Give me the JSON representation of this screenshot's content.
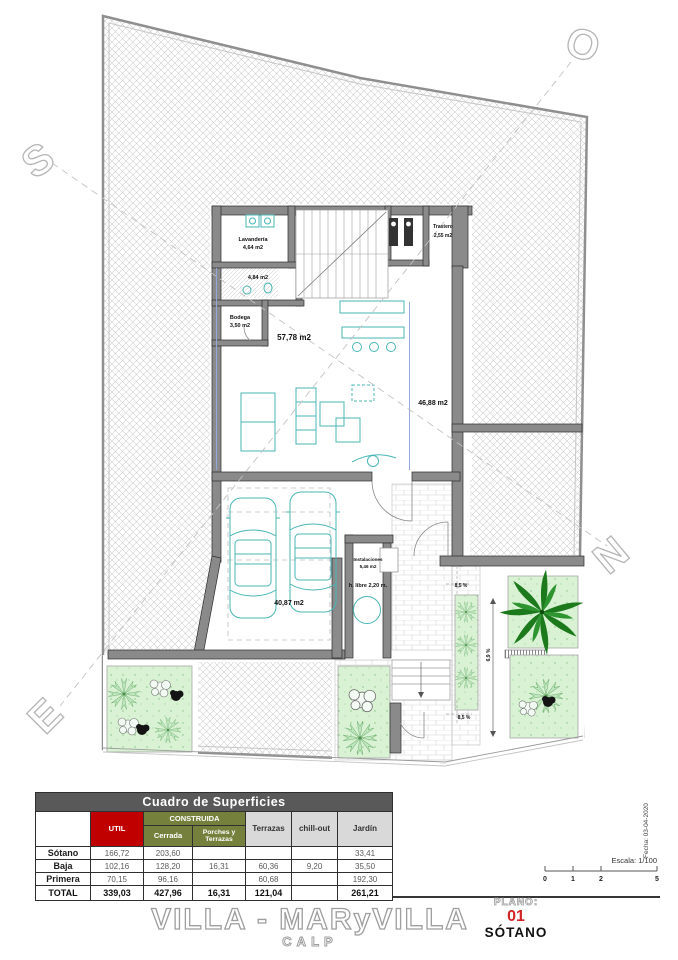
{
  "plan": {
    "compass": {
      "s": "S",
      "o": "O",
      "n": "N",
      "e": "E"
    },
    "rooms": {
      "lavanderia": {
        "name": "Lavandería",
        "area": "4,64 m2"
      },
      "bano": {
        "area": "4,84 m2"
      },
      "bodega": {
        "name": "Bodega",
        "area": "3,50 m2"
      },
      "trastero": {
        "name": "Trastero",
        "area": "2,55 m2"
      },
      "salon": {
        "area": "57,78 m2"
      },
      "terraza": {
        "area": "46,88 m2"
      },
      "garaje": {
        "area": "40,87 m2"
      },
      "instalaciones": {
        "name": "Instalaciones",
        "area": "5,46 m2"
      },
      "altura_libre": {
        "label": "h. libre 2,20 m."
      }
    },
    "ramps": {
      "top": "8,5 %",
      "middle": "6,9 %",
      "bottom": "8,5 %"
    }
  },
  "table": {
    "title": "Cuadro de Superficies",
    "construida_header": "CONSTRUIDA",
    "columns": {
      "util": "UTIL",
      "cerrada": "Cerrada",
      "porches": "Porches y Terrazas",
      "terrazas": "Terrazas",
      "chillout": "chill-out",
      "jardin": "Jardín"
    },
    "rows": [
      {
        "label": "Sótano",
        "cells": [
          "166,72",
          "203,60",
          "",
          "",
          "",
          "33,41"
        ]
      },
      {
        "label": "Baja",
        "cells": [
          "102,16",
          "128,20",
          "16,31",
          "60,36",
          "9,20",
          "35,50"
        ]
      },
      {
        "label": "Primera",
        "cells": [
          "70,15",
          "96,16",
          "",
          "60,68",
          "",
          "192,30"
        ]
      },
      {
        "label": "TOTAL",
        "cells": [
          "339,03",
          "427,96",
          "16,31",
          "121,04",
          "",
          "261,21"
        ]
      }
    ],
    "colors": {
      "header_bg": "#595959",
      "util_bg": "#C00000",
      "construida_bg": "#75803C",
      "light_bg": "#D9D9D9"
    }
  },
  "footer": {
    "escala": "Escala: 1/100",
    "fecha": "Fecha: 03-04-2020",
    "scale_ticks": [
      "0",
      "1",
      "2",
      "5"
    ],
    "project_title": "VILLA - MARyVILLA",
    "project_subtitle": "CALP",
    "plano_label": "PLANO:",
    "plano_number": "01",
    "plano_name": "SÓTANO"
  }
}
